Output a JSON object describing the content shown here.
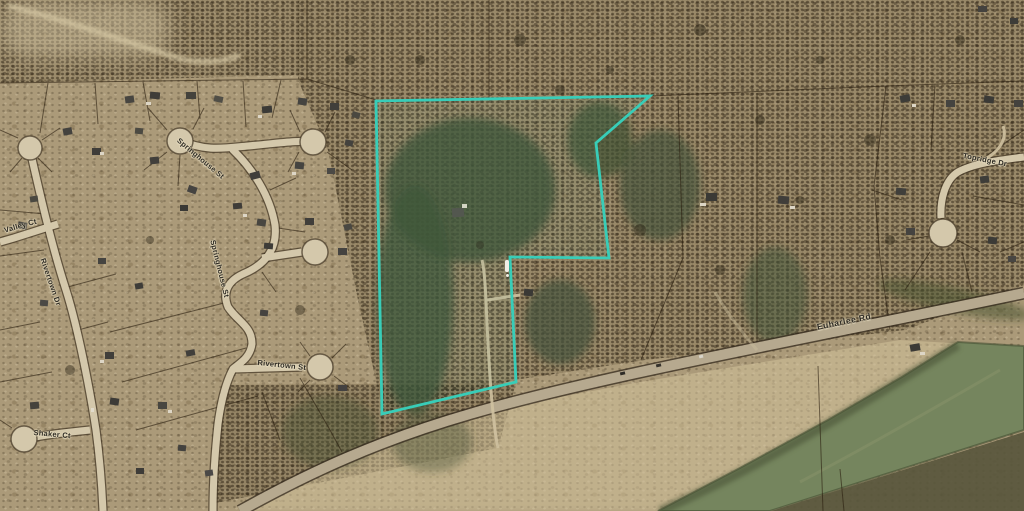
{
  "map": {
    "type": "aerial-parcel-view",
    "highlight_color": "#38cdb8",
    "water_color": "#75855e",
    "road_color": "#d4c8ab",
    "labels": {
      "valley_ct": "Valley Ct",
      "rivertown_dr": "Rivertown Dr",
      "springhouse_st": "Springhouse St",
      "springhouse_st_2": "Springhouse St",
      "rivertown_st": "Rivertown St",
      "shaker_ct": "Shaker Ct",
      "topridge_dr": "Topridge Dr",
      "euharlee_rd": "Euharlee Rd"
    }
  }
}
